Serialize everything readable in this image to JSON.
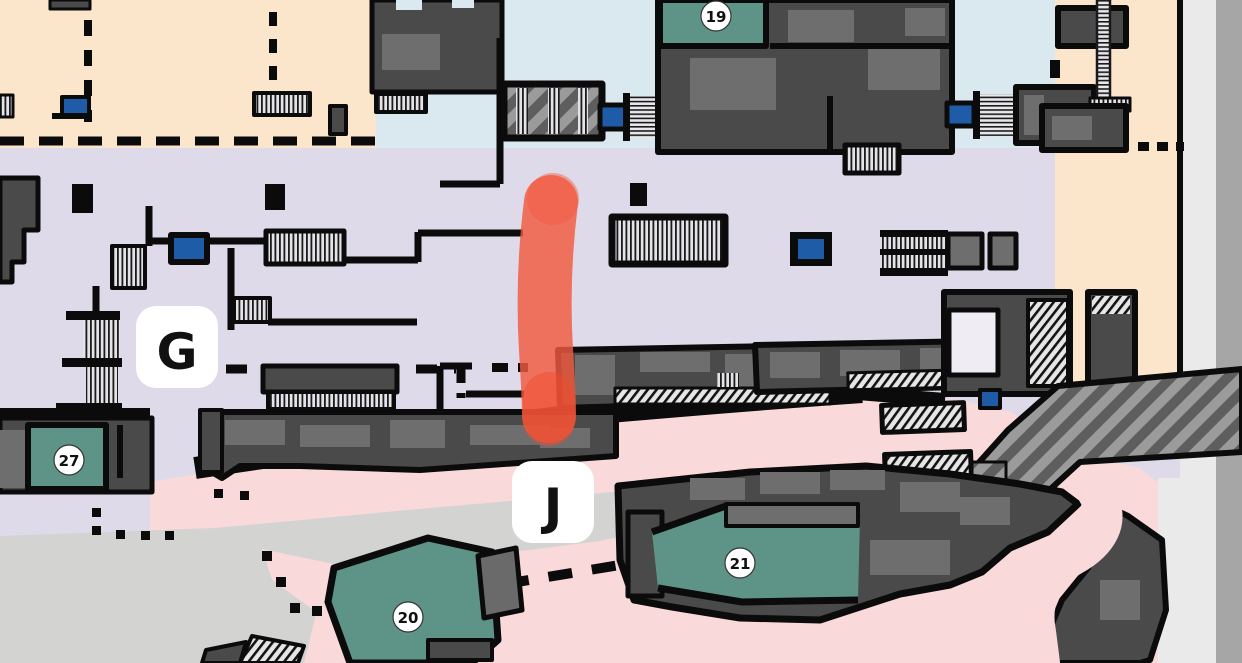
{
  "map": {
    "type": "indoor-station-floor-map",
    "zone_badges": [
      {
        "label": "G"
      },
      {
        "label": "J"
      }
    ],
    "numbered_markers": [
      {
        "label": "19"
      },
      {
        "label": "27"
      },
      {
        "label": "20"
      },
      {
        "label": "21"
      }
    ],
    "route_highlight": {
      "color": "#f2593f",
      "shape": "vertical-marker-stroke"
    },
    "colors": {
      "zone_g_floor": "#dedae9",
      "zone_j_floor": "#f9d9da",
      "upper_terrace": "#fbe6cb",
      "north_concourse": "#d9e9ef",
      "numbered_rooms": "#5e9487",
      "buildings": "#4a4a4a",
      "elevator": "#1e5ca8",
      "open_plaza": "#d3d4d1",
      "outline": "#0b0b0b"
    }
  }
}
